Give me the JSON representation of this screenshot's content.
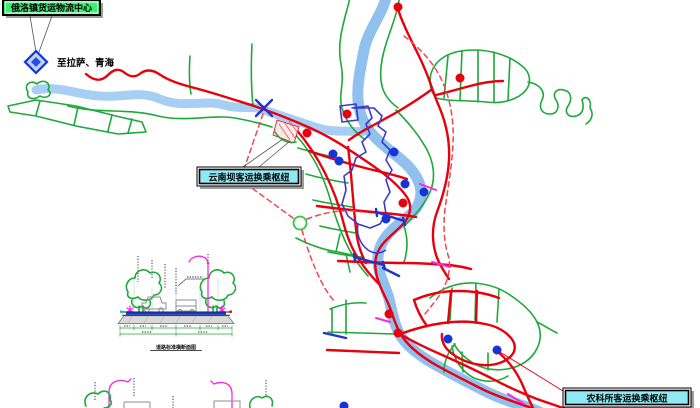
{
  "labels": {
    "logistics_center": "俄洛镇货运物流中心",
    "to_lhasa_qinghai": "至拉萨、青海",
    "yunnanba_hub": "云南坝客运换乘枢纽",
    "nongkesuo_hub": "农科所客运换乘枢纽",
    "section_title": "道路标准横断面图"
  },
  "colors": {
    "road_red": "#e8000f",
    "road_green": "#1fa83c",
    "river_blue": "#8fc0ee",
    "river_light": "#a7cef3",
    "boundary_red": "#f4454e",
    "bridge_blue": "#2233cc",
    "district_blue": "#3a3acd",
    "node_red": "#e8000f",
    "node_blue": "#1633d8",
    "magenta": "#f52be3",
    "label_green": "#3bed71",
    "label_cyan": "#90e8f4"
  },
  "map": {
    "nodes_red": [
      [
        398,
        7
      ],
      [
        460,
        78
      ],
      [
        347,
        114
      ],
      [
        307,
        133
      ],
      [
        403,
        203
      ],
      [
        389,
        314
      ],
      [
        398,
        333
      ]
    ],
    "nodes_blue": [
      [
        333,
        154
      ],
      [
        339,
        161
      ],
      [
        394,
        152
      ],
      [
        405,
        184
      ],
      [
        424,
        192
      ],
      [
        386,
        219
      ],
      [
        448,
        339
      ],
      [
        497,
        350
      ],
      [
        344,
        406
      ]
    ]
  }
}
